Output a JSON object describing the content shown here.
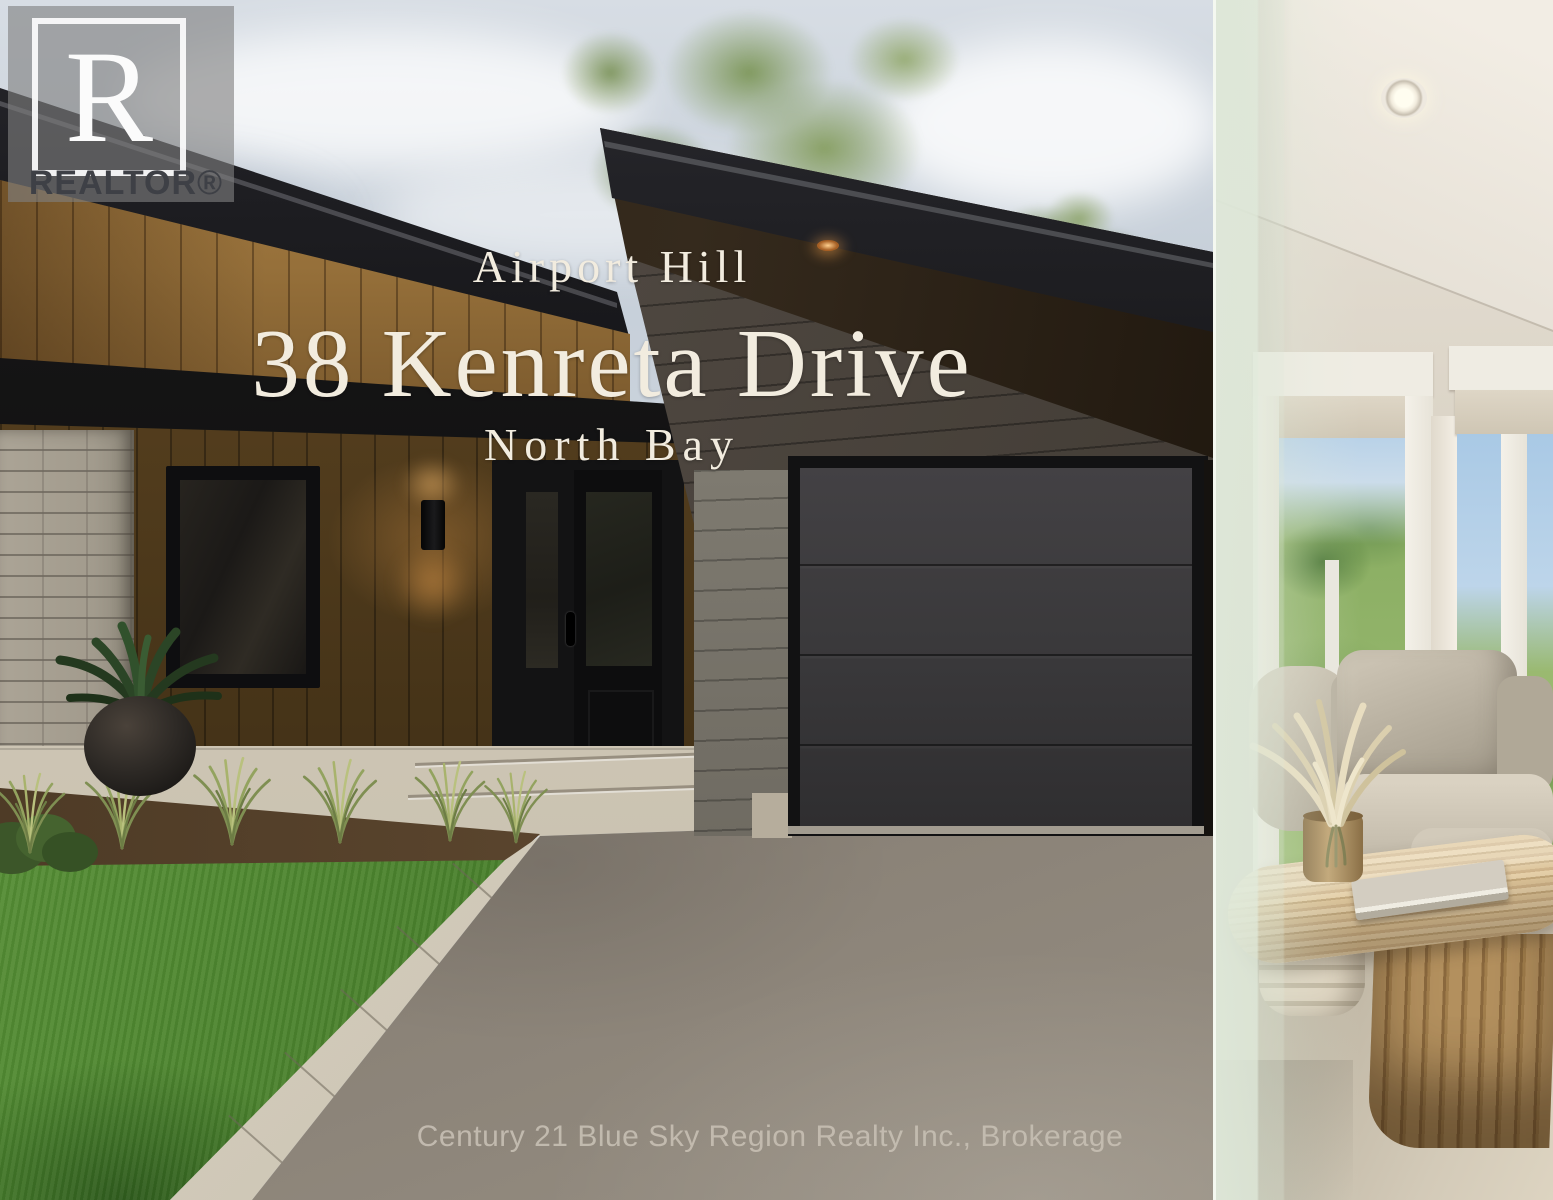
{
  "watermark": {
    "monogram": "R",
    "label": "REALTOR®"
  },
  "overlay": {
    "neighborhood": "Airport Hill",
    "address": "38 Kenreta Drive",
    "city": "North Bay"
  },
  "footer": {
    "brokerage": "Century 21 Blue Sky Region Realty Inc., Brokerage"
  },
  "palette": {
    "overlay_text": "#f2ecdf",
    "sky": "#ccd4dd",
    "roof": "#17171a",
    "wood_siding": "#96703a",
    "garage_siding": "#4e4740",
    "garage_door": "#39383a",
    "driveway": "#7d766c",
    "lawn": "#4f8733",
    "curb": "#d3ccbd",
    "brick_pillar": "#a29b8d",
    "sage_overlay": "#dfe8d8",
    "brokerage_text": "#c6beb2",
    "watermark_plate": "#7f7f7f"
  }
}
